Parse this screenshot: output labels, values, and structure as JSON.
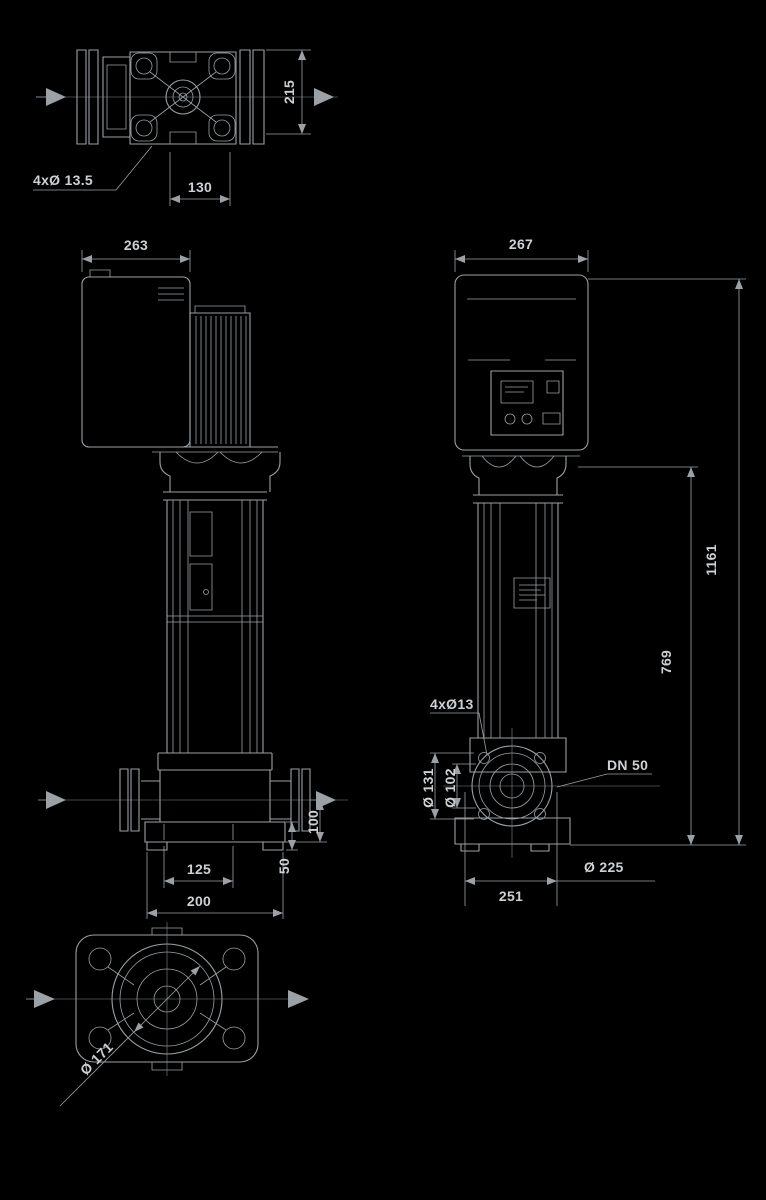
{
  "colors": {
    "background": "#000000",
    "line": "#9ba1a5",
    "label": "#cdd1d4"
  },
  "drawing": {
    "top_view": {
      "bolt_holes_label": "4xØ 13.5",
      "port_width": "130",
      "port_depth": "215"
    },
    "side_view": {
      "width": "263",
      "foot_hole_spacing": "125",
      "base_width": "200",
      "port_height": "100",
      "base_height": "50"
    },
    "front_view": {
      "width": "267",
      "total_height": "1161",
      "pump_height": "769",
      "bolt_holes_label": "4xØ13",
      "flange_size_label": "DN 50",
      "base_circle_diameter": "Ø 225",
      "base_width": "251",
      "flange_outer_diameter": "Ø 131",
      "flange_inner_diameter": "Ø 102"
    },
    "bottom_view": {
      "casing_diameter": "Ø 171"
    }
  }
}
